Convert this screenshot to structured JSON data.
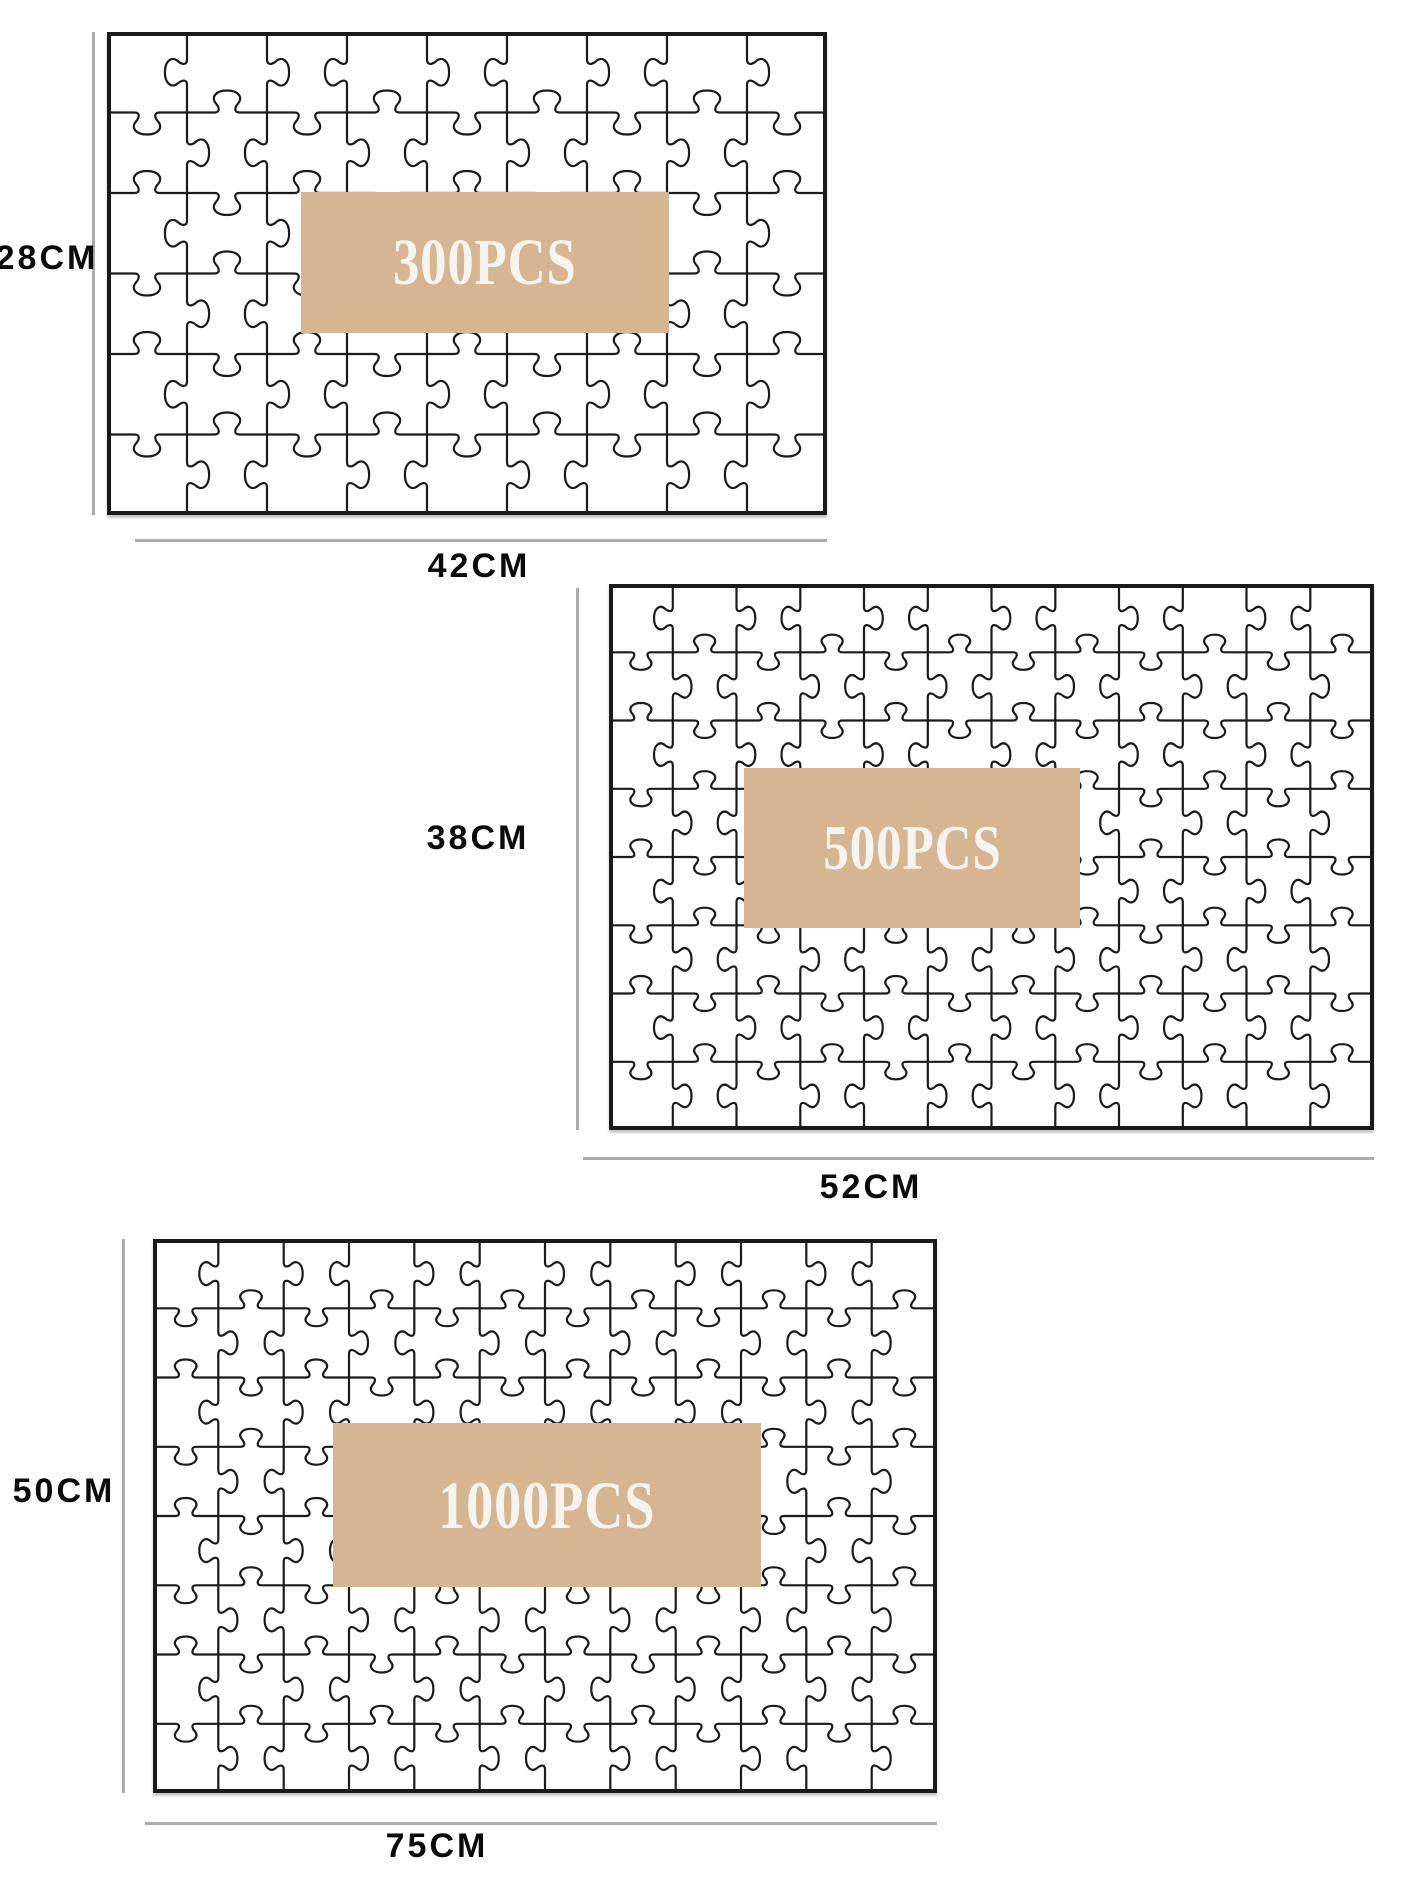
{
  "figure_title": "Puzzle size comparison diagram",
  "colors": {
    "page_bg": "#ffffff",
    "overlay": "#d5b592",
    "overlay_text": "#f7f4ef",
    "piece_line": "#1a1a1a",
    "dimension_line": "#ababab",
    "label_text": "#0a0a0a"
  },
  "puzzles": [
    {
      "pieces_label": "300PCS",
      "height_label": "28CM",
      "width_label": "42CM"
    },
    {
      "pieces_label": "500PCS",
      "height_label": "38CM",
      "width_label": "52CM"
    },
    {
      "pieces_label": "1000PCS",
      "height_label": "50CM",
      "width_label": "75CM"
    }
  ]
}
